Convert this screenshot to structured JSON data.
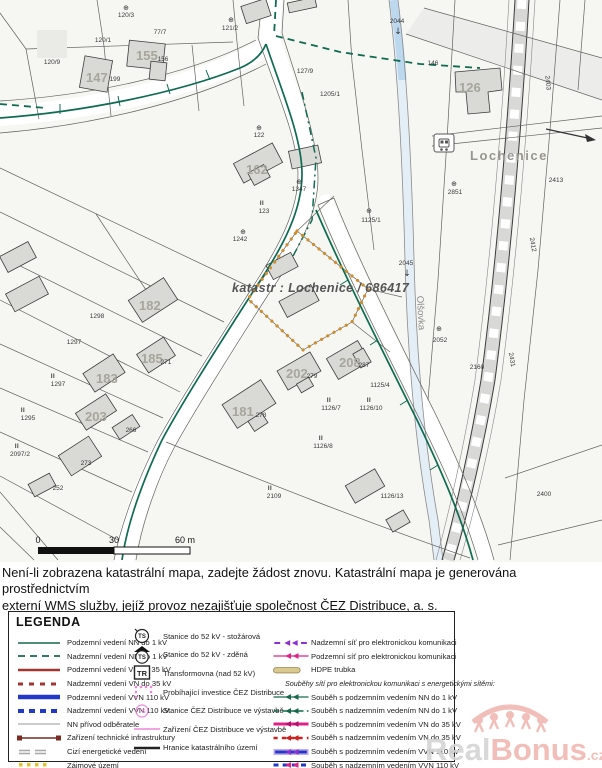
{
  "map": {
    "kataster_label": "katastr : Lochenice / 686417",
    "town_label": "Lochenice",
    "stream_label": "Olšovka",
    "scale_labels": {
      "zero": "0",
      "mid": "30",
      "end": "60 m"
    },
    "symbols": {
      "tree": "⊕",
      "structure": "II",
      "flow_arrow": "↓"
    },
    "house_numbers": [
      {
        "t": "147",
        "x": 86,
        "y": 82
      },
      {
        "t": "155",
        "x": 136,
        "y": 60
      },
      {
        "t": "162",
        "x": 246,
        "y": 174
      },
      {
        "t": "126",
        "x": 459,
        "y": 92
      },
      {
        "t": "182",
        "x": 139,
        "y": 310
      },
      {
        "t": "185",
        "x": 141,
        "y": 363
      },
      {
        "t": "183",
        "x": 96,
        "y": 383
      },
      {
        "t": "203",
        "x": 85,
        "y": 421
      },
      {
        "t": "181",
        "x": 232,
        "y": 416
      },
      {
        "t": "202",
        "x": 286,
        "y": 378
      },
      {
        "t": "208",
        "x": 339,
        "y": 367
      }
    ],
    "parcel_labels": [
      {
        "t": "120/3",
        "x": 126,
        "y": 17
      },
      {
        "t": "120/1",
        "x": 103,
        "y": 42
      },
      {
        "t": "77/7",
        "x": 160,
        "y": 34
      },
      {
        "t": "120/9",
        "x": 52,
        "y": 64
      },
      {
        "t": "121/2",
        "x": 230,
        "y": 30
      },
      {
        "t": "199",
        "x": 115,
        "y": 81
      },
      {
        "t": "156",
        "x": 163,
        "y": 61
      },
      {
        "t": "122",
        "x": 259,
        "y": 137
      },
      {
        "t": "123",
        "x": 264,
        "y": 213
      },
      {
        "t": "1347",
        "x": 299,
        "y": 191
      },
      {
        "t": "127/9",
        "x": 305,
        "y": 73
      },
      {
        "t": "1205/1",
        "x": 330,
        "y": 96
      },
      {
        "t": "146",
        "x": 433,
        "y": 65
      },
      {
        "t": "2044",
        "x": 397,
        "y": 23
      },
      {
        "t": "2045",
        "x": 406,
        "y": 265
      },
      {
        "t": "2052",
        "x": 440,
        "y": 342
      },
      {
        "t": "2851",
        "x": 455,
        "y": 194
      },
      {
        "t": "2413",
        "x": 556,
        "y": 182
      },
      {
        "t": "2412",
        "x": 531,
        "y": 245,
        "r": 80
      },
      {
        "t": "2431",
        "x": 510,
        "y": 360,
        "r": 80
      },
      {
        "t": "2403",
        "x": 546,
        "y": 83,
        "r": 85
      },
      {
        "t": "2160",
        "x": 477,
        "y": 369
      },
      {
        "t": "1242",
        "x": 240,
        "y": 241
      },
      {
        "t": "1125/1",
        "x": 371,
        "y": 222
      },
      {
        "t": "1125/4",
        "x": 380,
        "y": 387
      },
      {
        "t": "1126/7",
        "x": 331,
        "y": 410
      },
      {
        "t": "1126/10",
        "x": 371,
        "y": 410
      },
      {
        "t": "1126/8",
        "x": 323,
        "y": 448
      },
      {
        "t": "1126/13",
        "x": 392,
        "y": 498
      },
      {
        "t": "2097/2",
        "x": 20,
        "y": 456
      },
      {
        "t": "2109",
        "x": 274,
        "y": 498
      },
      {
        "t": "2400",
        "x": 544,
        "y": 496
      },
      {
        "t": "1298",
        "x": 97,
        "y": 318
      },
      {
        "t": "1297",
        "x": 74,
        "y": 344
      },
      {
        "t": "1297",
        "x": 58,
        "y": 386
      },
      {
        "t": "1295",
        "x": 28,
        "y": 420
      },
      {
        "t": "271",
        "x": 166,
        "y": 364
      },
      {
        "t": "278",
        "x": 261,
        "y": 417
      },
      {
        "t": "279",
        "x": 312,
        "y": 378
      },
      {
        "t": "287",
        "x": 364,
        "y": 367
      },
      {
        "t": "273",
        "x": 86,
        "y": 465
      },
      {
        "t": "266",
        "x": 131,
        "y": 432
      },
      {
        "t": "252",
        "x": 58,
        "y": 490
      }
    ],
    "tree_symbols": [
      {
        "x": 126,
        "y": 10
      },
      {
        "x": 231,
        "y": 22
      },
      {
        "x": 259,
        "y": 130
      },
      {
        "x": 299,
        "y": 184
      },
      {
        "x": 243,
        "y": 234
      },
      {
        "x": 439,
        "y": 331
      },
      {
        "x": 454,
        "y": 186
      },
      {
        "x": 369,
        "y": 213
      }
    ],
    "structure_marks": [
      {
        "x": 329,
        "y": 402
      },
      {
        "x": 369,
        "y": 402
      },
      {
        "x": 321,
        "y": 440
      },
      {
        "x": 53,
        "y": 378
      },
      {
        "x": 23,
        "y": 412
      },
      {
        "x": 17,
        "y": 448
      },
      {
        "x": 262,
        "y": 205
      },
      {
        "x": 270,
        "y": 490
      }
    ],
    "flow_arrows": [
      {
        "x": 398,
        "y": 34
      },
      {
        "x": 407,
        "y": 276
      }
    ]
  },
  "notice": {
    "line1": "Není-li zobrazena katastrální mapa, zadejte žádost znovu. Katastrální mapa je generována prostřednictvím",
    "line2": "externí WMS služby, jejíž provoz nezajišťuje společnost ČEZ Distribuce, a. s."
  },
  "legend": {
    "title": "LEGENDA",
    "col1": [
      {
        "label": "Podzemní vedení NN do 1 kV",
        "sample": "green-solid"
      },
      {
        "label": "Nadzemní vedení NN do 1 kV",
        "sample": "green-dash"
      },
      {
        "label": "Podzemní vedení VN do 35 kV",
        "sample": "red-solid"
      },
      {
        "label": "Nadzemní vedení VN do 35 kV",
        "sample": "red-dash"
      },
      {
        "label": "Podzemní vedení VVN 110 kV",
        "sample": "blue-thick"
      },
      {
        "label": "Nadzemní vedení VVN 110 kV",
        "sample": "blue-dash"
      },
      {
        "label": "NN přívod odběratele",
        "sample": "gray-solid"
      },
      {
        "label": "Zařízení technické infrastruktury",
        "sample": "tech-infra"
      },
      {
        "label": "Cizí energetické vedení",
        "sample": "foreign"
      },
      {
        "label": "Zájmové území",
        "sample": "interest-dots"
      }
    ],
    "col2": [
      {
        "label": "Stanice do 52 kV - stožárová",
        "sample": "ts-circle"
      },
      {
        "label": "Stanice do 52 kV - zděná",
        "sample": "ts-masonry"
      },
      {
        "label": "Transformovna (nad 52 kV)",
        "sample": "tr-box"
      },
      {
        "label": "Probíhající investice ČEZ Distribuce",
        "sample": "invest-dotted"
      },
      {
        "label": "Stanice ČEZ Distribuce ve výstavbě",
        "sample": "ts-pink"
      },
      {
        "label": "Zařízení ČEZ Distribuce ve výstavbě",
        "sample": "pink-line"
      },
      {
        "label": "Hranice katastrálního území",
        "sample": "black-line"
      }
    ],
    "col3": [
      {
        "label": "Nadzemní síť pro elektronickou komunikaci",
        "sample": "purple-dash-arrow"
      },
      {
        "label": "Podzemní síť pro elektronickou komunikaci",
        "sample": "magenta-arrow"
      },
      {
        "label": "HDPE trubka",
        "sample": "hdpe"
      },
      {
        "label": "Souběhy sítí pro elektronickou komunikaci s energetickými sítěmi:",
        "header": true
      },
      {
        "label": "Souběh s podzemním vedením NN do 1 kV",
        "sample": "green-arrow"
      },
      {
        "label": "Souběh s nadzemním vedením NN do 1 kV",
        "sample": "green-dash-arrow"
      },
      {
        "label": "Souběh s podzemním vedením VN do 35 kV",
        "sample": "magenta-thick-arrow"
      },
      {
        "label": "Souběh s nadzemním vedením VN do 35 kV",
        "sample": "red-dash-arrow"
      },
      {
        "label": "Souběh s podzemním vedením VVN 110 kV",
        "sample": "blue-glow-arrow"
      },
      {
        "label": "Souběh s nadzemním vedením VVN 110 kV",
        "sample": "blue-dash-arrow"
      }
    ]
  },
  "watermark": {
    "part1": "Real",
    "part2": "Bonus",
    "tld": ".cz"
  },
  "colors": {
    "power_nn_green": "#17694b",
    "power_vn_red": "#a33530",
    "power_vvn_blue": "#2238c8",
    "interest_orange": "#cf8f2f",
    "interest_yellow": "#e3c522",
    "cez_pink": "#ef86d8",
    "comm_magenta": "#e0218a",
    "comm_purple": "#8a2fd0",
    "watermark_red": "#f0b8b2"
  }
}
